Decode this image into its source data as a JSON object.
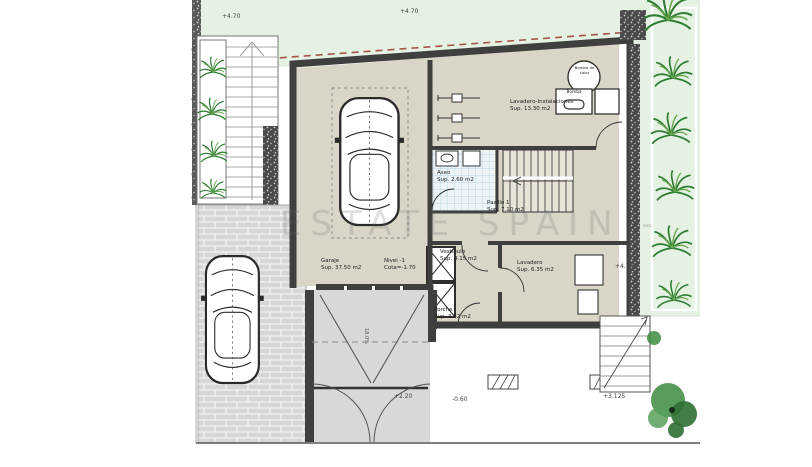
{
  "watermark": "ESTATE SPAIN -",
  "rooms": {
    "garaje": {
      "name": "Garaje",
      "area": "Sup. 37.50 m2"
    },
    "nivel": {
      "name": "Nivel -1",
      "area": "Cota=-1.70"
    },
    "lavadero_instalaciones": {
      "name": "Lavadero-Instalaciones",
      "area": "Sup. 13.30 m2"
    },
    "aseo": {
      "name": "Aseo",
      "area": "Sup. 2.60 m2"
    },
    "pasillo": {
      "name": "Pasillo 1",
      "area": "Sup. 7.10 m2"
    },
    "vestibulo": {
      "name": "Vestíbulo",
      "area": "Sup. 4.15 m2"
    },
    "lavadero": {
      "name": "Lavadero",
      "area": "Sup. 6.35 m2"
    },
    "porche": {
      "name": "Porche",
      "area": "Sup. 3.32 m2"
    }
  },
  "equipment": {
    "heat_pump": "Bomba de calor",
    "pump": "Bomba"
  },
  "elevations": {
    "garden_top_left": "+4.70",
    "garden_top_center": "+4.70",
    "garden_right": "+4.70",
    "ramp": "+2.20",
    "terrace": "-0.60",
    "garden_steps": "+3.125"
  },
  "ramp": {
    "slope": "18.0%"
  },
  "colors": {
    "wall": "#3f3f3f",
    "floor": "#d9d5c7",
    "garden": "#e4f1e3",
    "boundary_dashed": "#a85448",
    "ramp_paving": "#d8d8d8"
  }
}
